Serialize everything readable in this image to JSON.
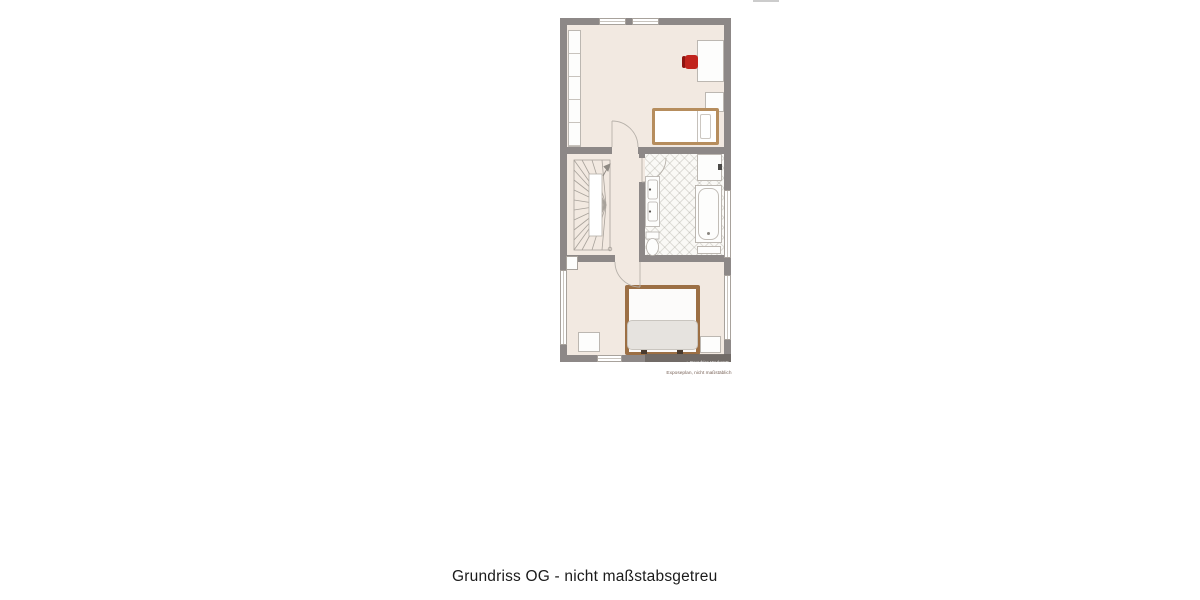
{
  "caption": {
    "text": "Grundriss OG - nicht maßstabsgetreu"
  },
  "plan": {
    "disclaimer": "Exposeplan, nicht maßstäblich",
    "watermark_text": "⌂ Grundriss Werkstatt",
    "colors": {
      "wall": "#8d8887",
      "floor": "#f2e9e1",
      "bathroom_floor": "#faf9f6",
      "bed_frame": "#9c6f44",
      "single_bed_frame": "#b68d5d",
      "chair_red": "#c1241d",
      "duvet": "#e6e3df"
    }
  }
}
